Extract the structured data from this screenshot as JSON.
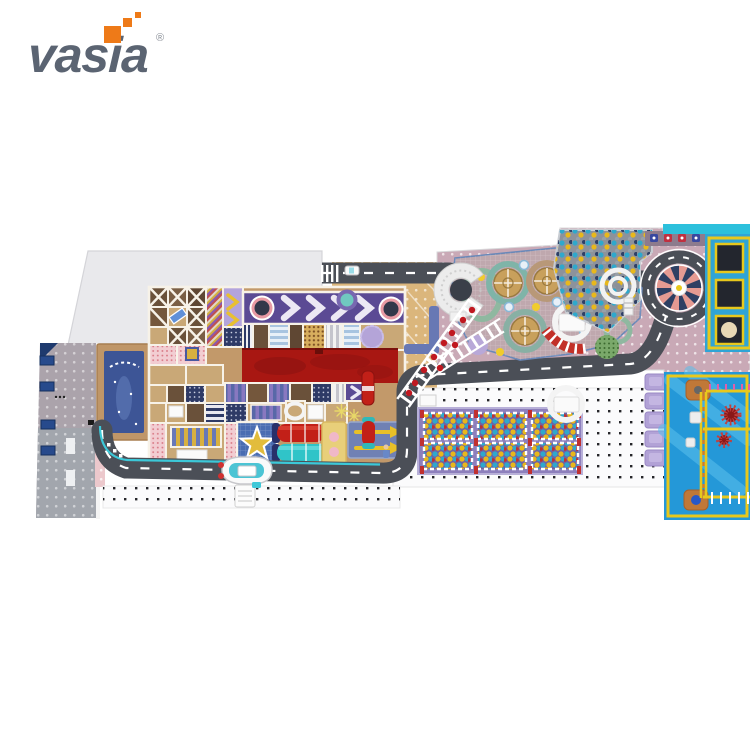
{
  "page": {
    "background": "#ffffff",
    "type": "product-image",
    "subject": "indoor playground floor plan top view"
  },
  "logo": {
    "text": "vasia",
    "registered": "®",
    "text_color": "#5b6472",
    "pixel_color": "#ee7a18"
  },
  "palette": {
    "road": "#4b4f57",
    "road_marking": "#ffffff",
    "cyan_trim": "#3cc8d8",
    "light_floor": "#e9e9ec",
    "entry_gray": "#aba3ab",
    "pool_blue": "#3d5596",
    "structure_tan": "#c2996a",
    "brown_cell": "#6a513a",
    "purple_band": "#5b4a94",
    "red_carpet": "#a81712",
    "star_pad_blue": "#4a6db2",
    "star_yellow": "#e2bc3c",
    "tube_red": "#c22018",
    "tube_cyan": "#30c4c8",
    "tan_floor": "#dbb67c",
    "pink_floor": "#c9a9b6",
    "ball_teal": "#2fa8cc",
    "ball_yellow": "#e8b81c",
    "carousel_salmon": "#e59a92",
    "carousel_navy": "#2e3f63",
    "trampoline_panel_blue": "#2fa4d6",
    "frame_yellow": "#e8c81c",
    "adventure_blue": "#2498d8",
    "soft_block_purple": "#b2a2d6"
  },
  "zones": {
    "empty-floor": "#e9e9ec",
    "entry-walkway": "#aba3ab",
    "splash-pool": "#3d5596",
    "soft-play-structure": "#c2996a",
    "chevron-runway": "#5b4a94",
    "red-carpet": "#a81712",
    "star-trampoline": "#e2bc3c",
    "tube-slides": "#c22018",
    "race-track": "#4b4f57",
    "rope-bridge": "#ffffff",
    "play-hills": "#c8a05c",
    "ball-pit": "#8d929b",
    "spiral-slide": "#f2f2f2",
    "carousel-wheel": "#e59a92",
    "trampoline-wall": "#2fa4d6",
    "crossing-course": "#2498d8",
    "ball-pit-cells": "#6f62a2",
    "ferry-boat": "#fafafa"
  }
}
